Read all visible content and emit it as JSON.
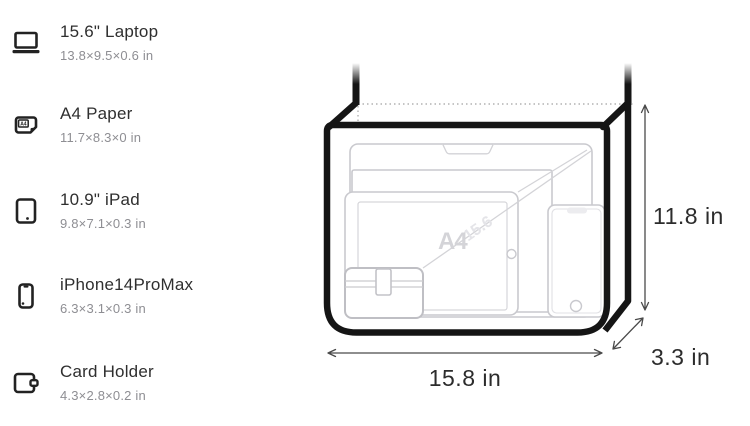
{
  "items": [
    {
      "name": "15.6\" Laptop",
      "dimensions": "13.8×9.5×0.6 in",
      "icon": "laptop-icon"
    },
    {
      "name": "A4 Paper",
      "dimensions": "11.7×8.3×0 in",
      "icon": "a4-paper-icon",
      "icon_label": "A4"
    },
    {
      "name": "10.9\" iPad",
      "dimensions": "9.8×7.1×0.3 in",
      "icon": "ipad-icon"
    },
    {
      "name": "iPhone14ProMax",
      "dimensions": "6.3×3.1×0.3 in",
      "icon": "iphone-icon"
    },
    {
      "name": "Card Holder",
      "dimensions": "4.3×2.8×0.2 in",
      "icon": "card-holder-icon"
    }
  ],
  "diagram": {
    "width_label": "15.8 in",
    "height_label": "11.8 in",
    "depth_label": "3.3 in",
    "watermark_a4": "A4",
    "watermark_laptop": "15.6",
    "colors": {
      "bag_outline": "#151515",
      "inner_item_stroke": "#c9c9ce",
      "dotted_line": "#b2b2b2",
      "arrow": "#4a4a4a",
      "label_text": "#2c2c2c",
      "background": "#ffffff"
    }
  }
}
